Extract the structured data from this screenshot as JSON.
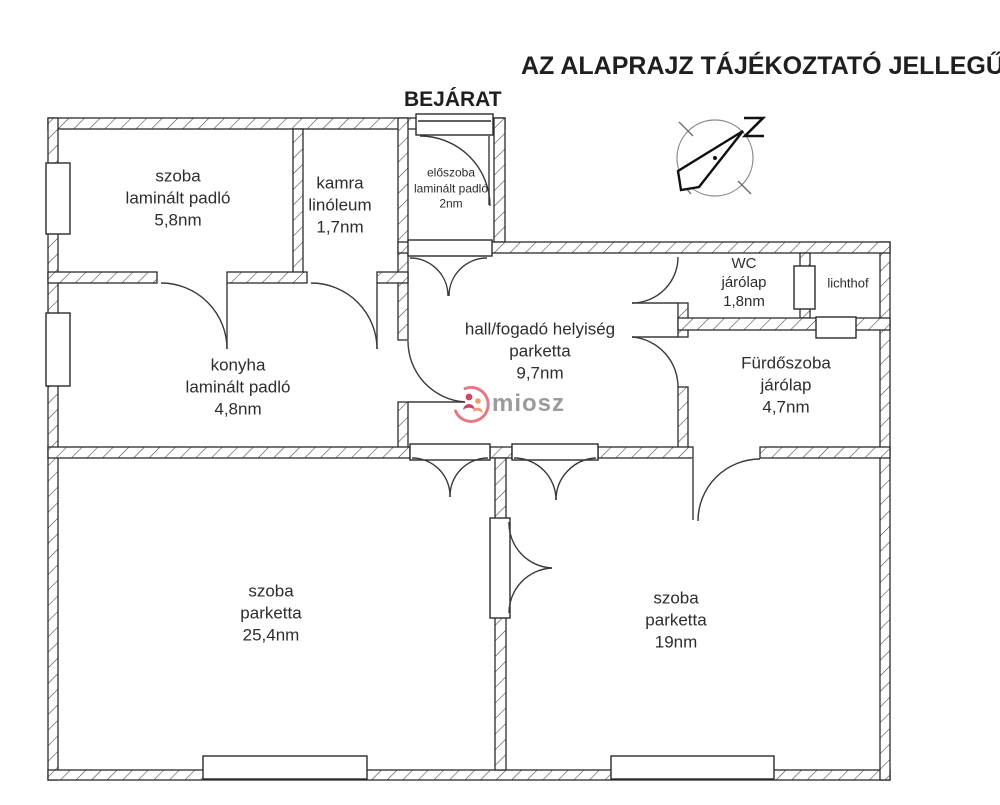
{
  "disclaimer_title": "AZ ALAPRAJZ TÁJÉKOZTATÓ JELLEGŰ!",
  "entrance_label": "BEJÁRAT",
  "watermark": {
    "brand": "miosz"
  },
  "rooms": [
    {
      "name": "szoba",
      "floor": "laminált padló",
      "area": "5,8nm"
    },
    {
      "name": "kamra",
      "floor": "linóleum",
      "area": "1,7nm"
    },
    {
      "name": "előszoba",
      "floor": "laminált padló",
      "area": "2nm"
    },
    {
      "name": "WC",
      "floor": "járólap",
      "area": "1,8nm"
    },
    {
      "name": "lichthof"
    },
    {
      "name": "hall/fogadó helyiség",
      "floor": "parketta",
      "area": "9,7nm"
    },
    {
      "name": "Fürdőszoba",
      "floor": "járólap",
      "area": "4,7nm"
    },
    {
      "name": "konyha",
      "floor": "laminált padló",
      "area": "4,8nm"
    },
    {
      "name": "szoba",
      "floor": "parketta",
      "area": "25,4nm"
    },
    {
      "name": "szoba",
      "floor": "parketta",
      "area": "19nm"
    }
  ],
  "colors": {
    "plan_line": "#2b2b2b",
    "hatch_line": "#3c3c3c",
    "watermark_text": "#9b9b9b",
    "logo_red": "#cf4761",
    "logo_orange": "#ef9a72",
    "compass_circle": "#8a8a8a"
  }
}
